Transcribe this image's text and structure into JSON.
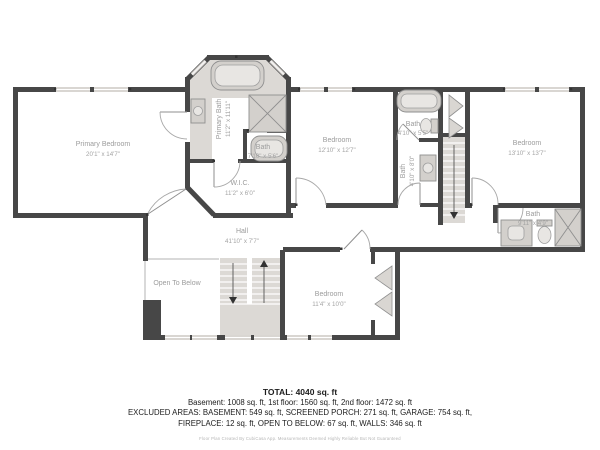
{
  "plan": {
    "rooms": [
      {
        "id": "primary-bedroom",
        "label": "Primary Bedroom",
        "dims": "20'1\" x 14'7\""
      },
      {
        "id": "primary-bath",
        "label": "Primary Bath",
        "dims": "11'2\" x 11'11\""
      },
      {
        "id": "bath-ensuite",
        "label": "Bath",
        "dims": "7'10\" x 5'6\""
      },
      {
        "id": "wic",
        "label": "W.I.C.",
        "dims": "11'2\" x 6'0\""
      },
      {
        "id": "bedroom-middle",
        "label": "Bedroom",
        "dims": "12'10\" x 12'7\""
      },
      {
        "id": "bath-top",
        "label": "Bath",
        "dims": "4'10\" x 5'5\""
      },
      {
        "id": "bath-center",
        "label": "Bath",
        "dims": "4'10\" x 8'0\""
      },
      {
        "id": "bedroom-right",
        "label": "Bedroom",
        "dims": "13'10\" x 13'7\""
      },
      {
        "id": "bath-right",
        "label": "Bath",
        "dims": "9'11\" x 4'9\""
      },
      {
        "id": "hall",
        "label": "Hall",
        "dims": "41'10\" x 7'7\""
      },
      {
        "id": "open-to-below",
        "label": "Open To Below",
        "dims": ""
      },
      {
        "id": "bedroom-bottom",
        "label": "Bedroom",
        "dims": "11'4\" x 10'0\""
      }
    ]
  },
  "summary": {
    "total": "TOTAL: 4040 sq. ft",
    "floors": "Basement: 1008 sq. ft, 1st floor: 1560 sq. ft, 2nd floor: 1472 sq. ft",
    "excluded1": "EXCLUDED AREAS: BASEMENT: 549 sq. ft, SCREENED PORCH: 271 sq. ft, GARAGE: 754 sq. ft,",
    "excluded2": "FIREPLACE: 12 sq. ft, OPEN TO BELOW: 67 sq. ft, WALLS: 346 sq. ft",
    "credit": "Floor Plan Created By CubiCasa App. Measurements Deemed Highly Reliable But Not Guaranteed"
  },
  "colors": {
    "wall": "#474747",
    "tile": "#dcd9d5",
    "fixture": "#d3d0cc",
    "label": "#9c9c9c",
    "text": "#1c1c1c"
  }
}
